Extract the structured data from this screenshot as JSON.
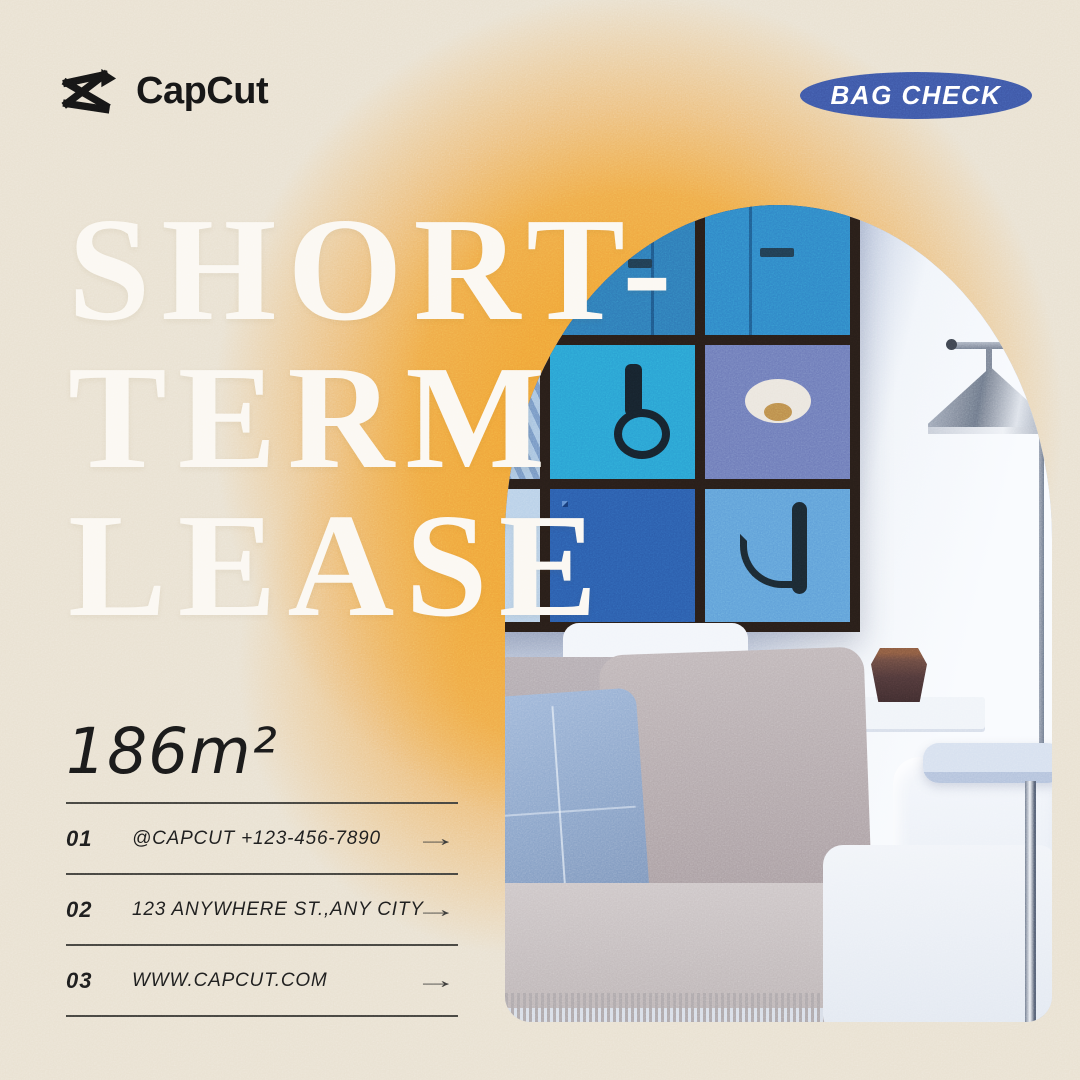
{
  "poster": {
    "brand": {
      "name": "CapCut"
    },
    "badge": {
      "label": "BAG CHECK"
    },
    "title": {
      "line1": "SHORT-",
      "line2": "TERM",
      "line3": "LEASE"
    },
    "area": {
      "value": "186m²"
    },
    "contact": {
      "arrow_icon": "→",
      "rows": [
        {
          "num": "01",
          "label": "@CAPCUT  +123-456-7890"
        },
        {
          "num": "02",
          "label": "123 ANYWHERE ST.,ANY CITY"
        },
        {
          "num": "03",
          "label": "WWW.CAPCUT.COM"
        }
      ]
    },
    "photo": {
      "alt": "living room with arched cutout: blue door gallery wall, white sofa, floor lamp"
    },
    "colors": {
      "bg": "#e9e1d1",
      "glow": "#f0a235",
      "badge_blue": "#3d56a5",
      "title_white": "#fbf8f2",
      "ink": "#1d1d1d",
      "rule": "#45443f"
    }
  }
}
